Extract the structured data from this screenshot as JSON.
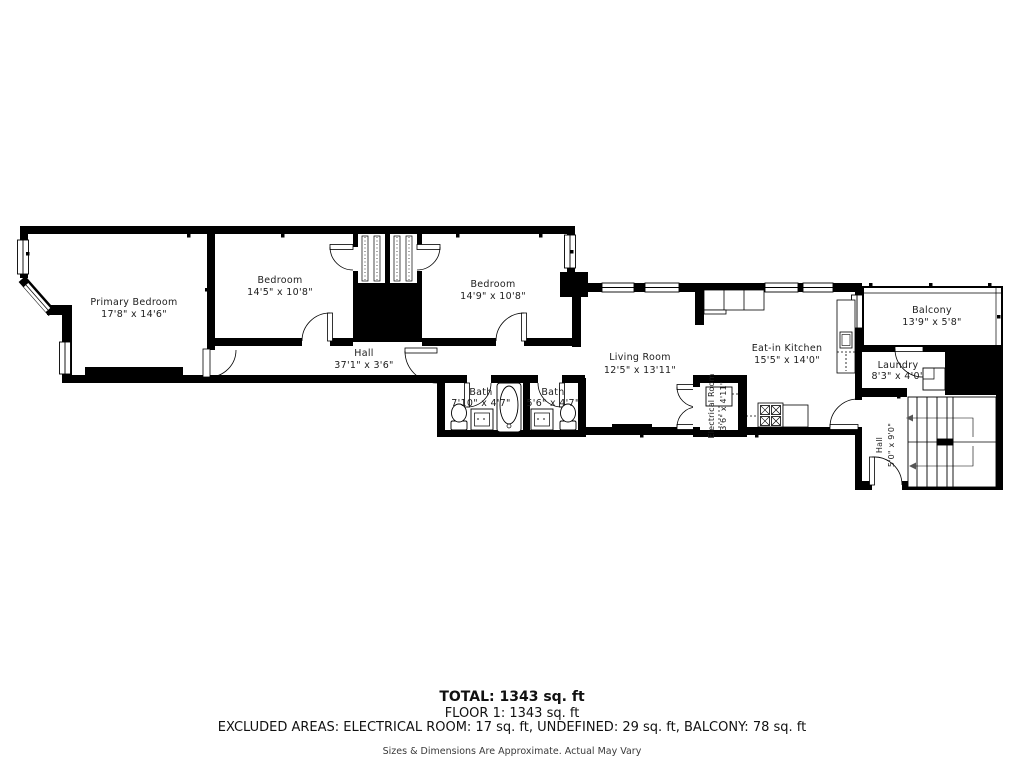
{
  "colors": {
    "wall": "#000000",
    "background": "#ffffff",
    "label": "#1c1c1c"
  },
  "rooms": [
    {
      "key": "primary-bedroom",
      "name": "Primary Bedroom",
      "dims": "17'8\" x 14'6\""
    },
    {
      "key": "bedroom-1",
      "name": "Bedroom",
      "dims": "14'5\" x 10'8\""
    },
    {
      "key": "bedroom-2",
      "name": "Bedroom",
      "dims": "14'9\" x 10'8\""
    },
    {
      "key": "hall",
      "name": "Hall",
      "dims": "37'1\" x 3'6\""
    },
    {
      "key": "bath-1",
      "name": "Bath",
      "dims": "7'10\" x 4'7\""
    },
    {
      "key": "bath-2",
      "name": "Bath",
      "dims": "5'6\" x 4'7\""
    },
    {
      "key": "living-room",
      "name": "Living Room",
      "dims": "12'5\" x 13'11\""
    },
    {
      "key": "eat-in-kitchen",
      "name": "Eat-in Kitchen",
      "dims": "15'5\" x 14'0\""
    },
    {
      "key": "electrical-room",
      "name": "Electrical Room",
      "dims": "3'6\" x 4'11\""
    },
    {
      "key": "balcony",
      "name": "Balcony",
      "dims": "13'9\" x 5'8\""
    },
    {
      "key": "laundry",
      "name": "Laundry",
      "dims": "8'3\" x 4'0\""
    },
    {
      "key": "hall-2",
      "name": "Hall",
      "dims": "5'0\" x 9'0\""
    }
  ],
  "summary": {
    "total": "TOTAL: 1343 sq. ft",
    "floor": "FLOOR 1: 1343 sq. ft",
    "excluded": "EXCLUDED AREAS: ELECTRICAL ROOM: 17 sq. ft, UNDEFINED: 29 sq. ft, BALCONY: 78 sq. ft",
    "disclaimer": "Sizes & Dimensions Are Approximate. Actual May Vary"
  }
}
